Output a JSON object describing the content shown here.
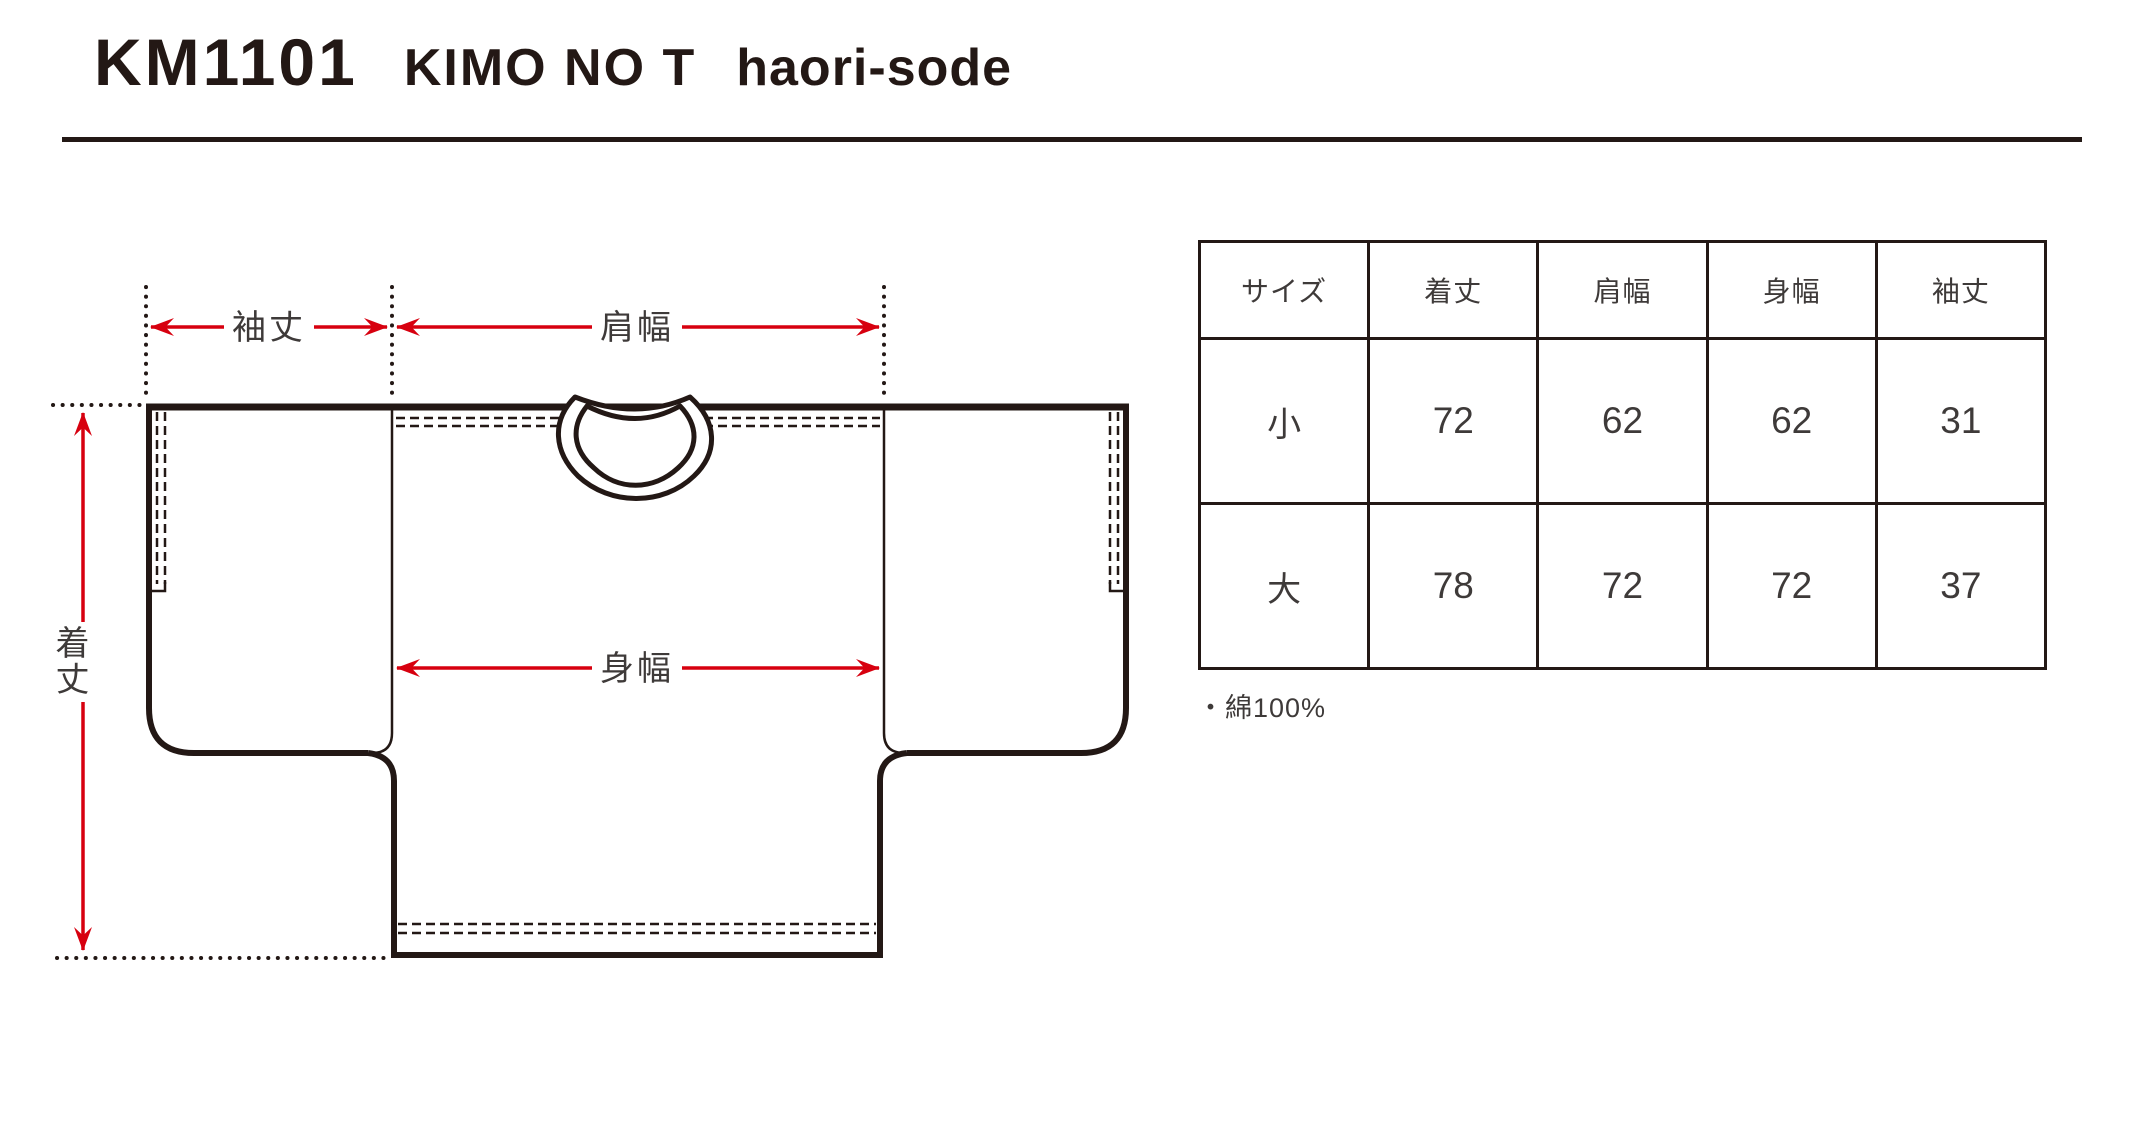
{
  "header": {
    "model": "KM1101",
    "name": "KIMO NO T",
    "variant": "haori-sode"
  },
  "diagram": {
    "labels": {
      "sleeve_length": "袖丈",
      "shoulder_width": "肩幅",
      "body_width": "身幅",
      "body_length": "着丈"
    },
    "colors": {
      "ink": "#231815",
      "measure_red": "#d7000f",
      "label_text": "#3e3a39"
    }
  },
  "size_table": {
    "columns": [
      "サイズ",
      "着丈",
      "肩幅",
      "身幅",
      "袖丈"
    ],
    "rows": [
      {
        "label": "小",
        "values": [
          "72",
          "62",
          "62",
          "31"
        ]
      },
      {
        "label": "大",
        "values": [
          "78",
          "72",
          "72",
          "37"
        ]
      }
    ],
    "note": "・綿100%"
  }
}
